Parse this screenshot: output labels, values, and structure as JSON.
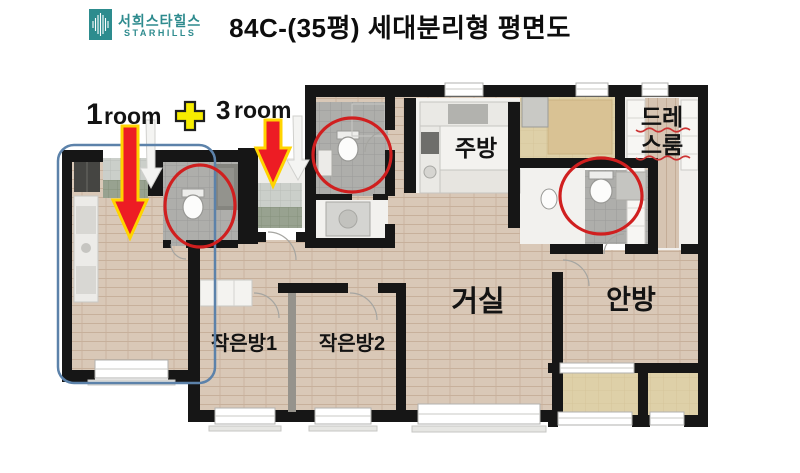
{
  "header": {
    "brand_kr": "서희스타힐스",
    "brand_en": "STARHILLS",
    "title": "84C-(35평) 세대분리형 평면도"
  },
  "annotation": {
    "left_unit_number": "1",
    "left_unit_word": "room",
    "plus": "+",
    "right_unit_number": "3",
    "right_unit_word": "room"
  },
  "rooms": {
    "kitchen": "주방",
    "dressroom_line1": "드레",
    "dressroom_line2": "스룸",
    "living_room": "거실",
    "master_bedroom": "안방",
    "small_room1": "작은방1",
    "small_room2": "작은방2"
  },
  "colors": {
    "brand_teal": "#2d8c8e",
    "wall_black": "#161616",
    "wood_floor": "#d9c8b7",
    "balcony_beige": "#ded0a8",
    "bath_tile_gray": "#aeaeab",
    "entry_tile_green": "#98a290",
    "highlight_red": "#d01f1f",
    "arrow_red": "#ed1c24",
    "arrow_outline_yellow": "#ffd400",
    "unit_outline_blue": "#5c82aa"
  }
}
